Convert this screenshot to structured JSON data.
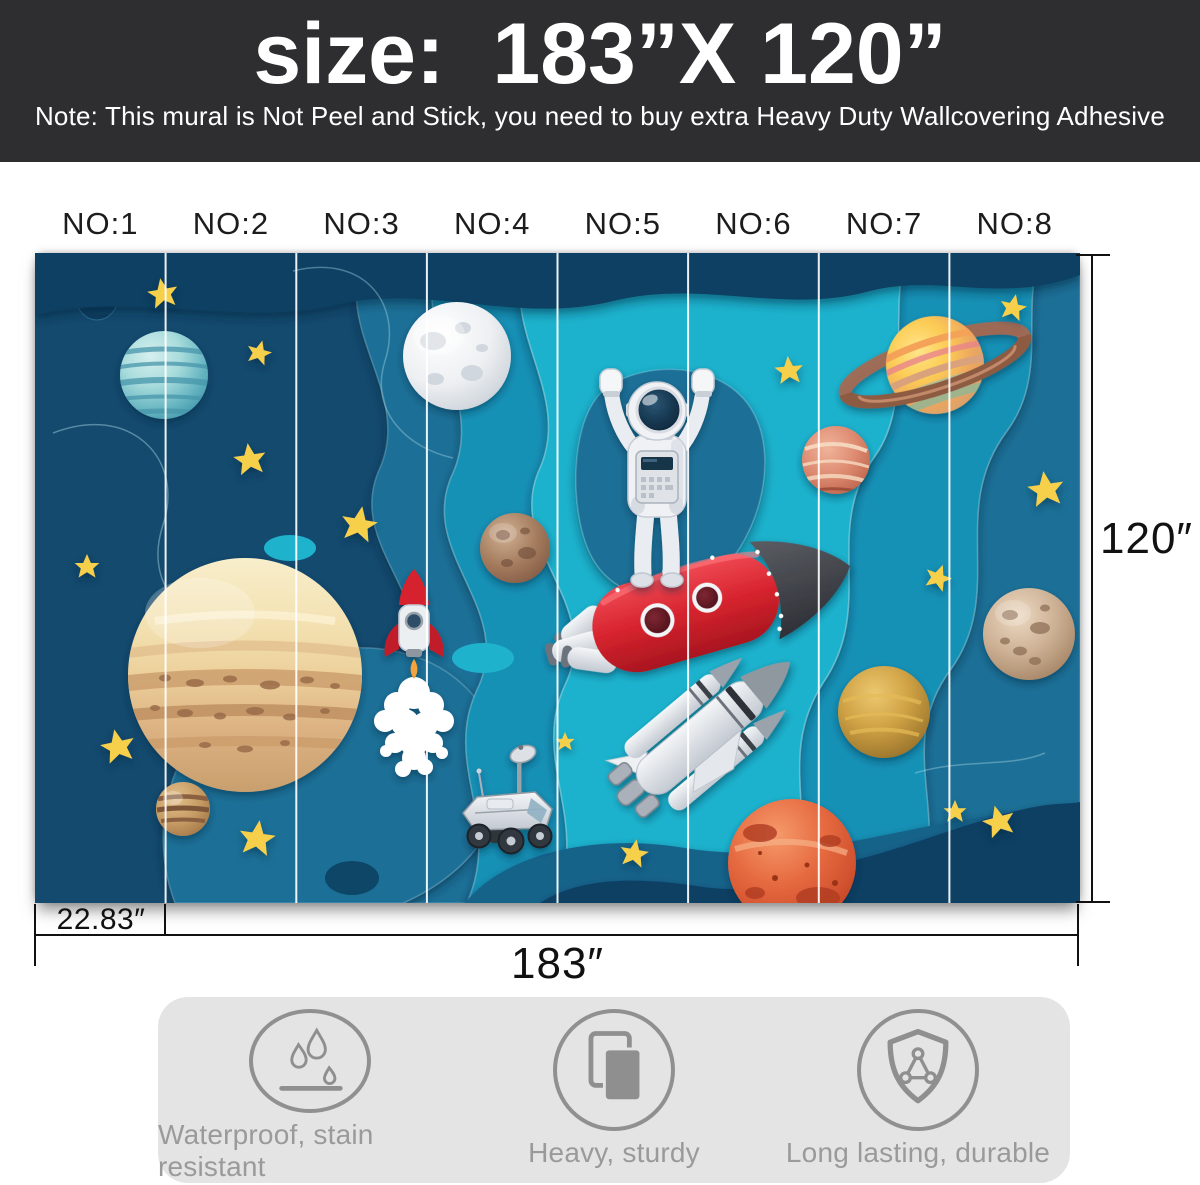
{
  "header": {
    "title": "size:  183”X 120”",
    "note": "Note: This mural is Not Peel and Stick, you need to buy extra Heavy Duty Wallcovering Adhesive",
    "bg_color": "#2e2e30",
    "text_color": "#ffffff"
  },
  "panel_labels": [
    "NO:1",
    "NO:2",
    "NO:3",
    "NO:4",
    "NO:5",
    "NO:6",
    "NO:7",
    "NO:8"
  ],
  "dimensions": {
    "total_width": "183″",
    "total_height": "120″",
    "panel_width": "22.83″"
  },
  "features": [
    {
      "icon": "water-drops-icon",
      "label": "Waterproof, stain resistant"
    },
    {
      "icon": "stacked-panels-icon",
      "label": "Heavy, sturdy"
    },
    {
      "icon": "shield-icon",
      "label": "Long lasting, durable"
    }
  ],
  "mural": {
    "style": "paper-cut layered space scene",
    "panel_count": 8,
    "elements": [
      "astronaut standing on red rocket",
      "space shuttle",
      "small rocket with smoke trail",
      "moon rover",
      "moon",
      "saturn with rings",
      "jupiter",
      "mars",
      "teal striped planet",
      "red marbled planet",
      "cratered planets",
      "gold planet",
      "yellow stars"
    ],
    "colors": {
      "navy_dark": "#0f3f63",
      "navy": "#134a6e",
      "blue_mid": "#1a6f97",
      "teal": "#1391b6",
      "teal_bright": "#1fb2cd",
      "star_yellow": "#f6cf4c",
      "rocket_red": "#d6232e"
    }
  }
}
